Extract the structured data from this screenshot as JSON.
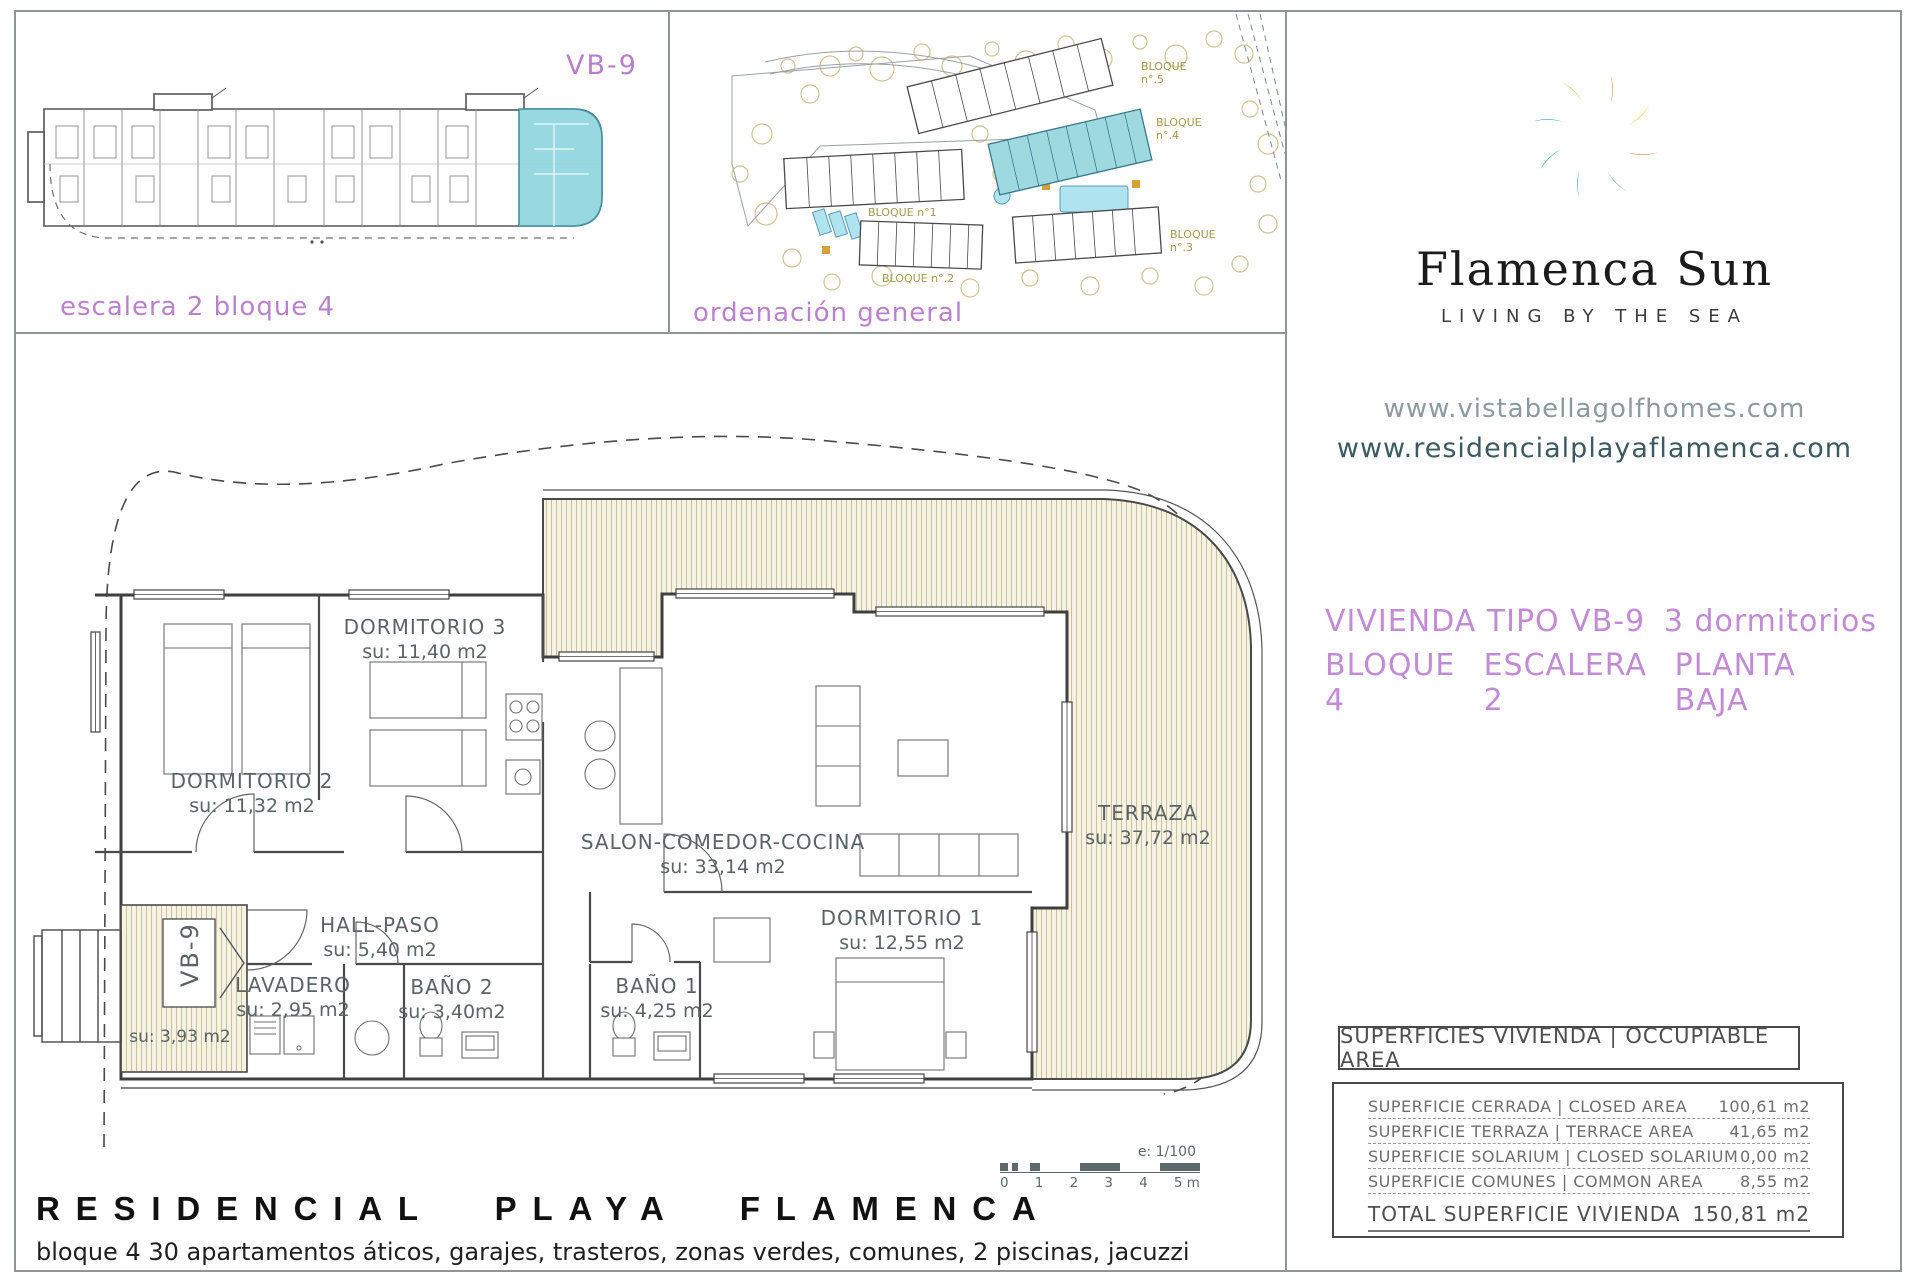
{
  "unit_panel": {
    "tag": "VB-9",
    "caption": "escalera 2 bloque 4"
  },
  "site_panel": {
    "caption": "ordenación general",
    "labels": [
      {
        "l1": "BLOQUE",
        "l2": "n°.5"
      },
      {
        "l1": "BLOQUE",
        "l2": "n°.4"
      },
      {
        "l1": "BLOQUE",
        "l2": "n°.3"
      },
      {
        "l1": "BLOQUE n°.2",
        "l2": ""
      },
      {
        "l1": "BLOQUE n°1",
        "l2": ""
      }
    ]
  },
  "brand": {
    "name": "Flamenca Sun",
    "tagline": "LIVING BY THE SEA"
  },
  "links": {
    "site1": "www.vistabellagolfhomes.com",
    "site2": "www.residencialplayaflamenca.com"
  },
  "listing": {
    "type": "VIVIENDA TIPO VB-9",
    "bedrooms": "3 dormitorios",
    "block": "BLOQUE 4",
    "stair": "ESCALERA 2",
    "floor": "PLANTA BAJA"
  },
  "plan": {
    "vb9_tag": "VB-9",
    "porch_area": "su: 3,93 m2",
    "rooms": {
      "d3": {
        "n": "DORMITORIO 3",
        "a": "su: 11,40 m2"
      },
      "d2": {
        "n": "DORMITORIO 2",
        "a": "su: 11,32 m2"
      },
      "salon": {
        "n": "SALON-COMEDOR-COCINA",
        "a": "su: 33,14 m2"
      },
      "terraza": {
        "n": "TERRAZA",
        "a": "su: 37,72 m2"
      },
      "d1": {
        "n": "DORMITORIO 1",
        "a": "su: 12,55 m2"
      },
      "hall": {
        "n": "HALL-PASO",
        "a": "su: 5,40 m2"
      },
      "lavadero": {
        "n": "LAVADERO",
        "a": "su: 2,95 m2"
      },
      "bano2": {
        "n": "BAÑO 2",
        "a": "su: 3,40m2"
      },
      "bano1": {
        "n": "BAÑO 1",
        "a": "su: 4,25 m2"
      }
    }
  },
  "scalebar": {
    "scale": "e: 1/100",
    "ticks": [
      "0",
      "1",
      "2",
      "3",
      "4",
      "5 m"
    ]
  },
  "table": {
    "header": "SUPERFICIES VIVIENDA | OCCUPIABLE AREA",
    "rows": [
      {
        "label": "SUPERFICIE CERRADA | CLOSED AREA",
        "value": "100,61 m2"
      },
      {
        "label": "SUPERFICIE TERRAZA   | TERRACE AREA",
        "value": "41,65 m2"
      },
      {
        "label": "SUPERFICIE SOLARIUM | CLOSED SOLARIUM",
        "value": "0,00 m2"
      },
      {
        "label": "SUPERFICIE COMUNES | COMMON AREA",
        "value": "8,55 m2"
      }
    ],
    "total_label": "TOTAL SUPERFICIE VIVIENDA",
    "total_value": "150,81 m2"
  },
  "footer": {
    "title": "RESIDENCIAL PLAYA FLAMENCA",
    "subtitle": "bloque 4 30 apartamentos áticos, garajes, trasteros, zonas verdes, comunes, 2 piscinas, jacuzzi"
  }
}
